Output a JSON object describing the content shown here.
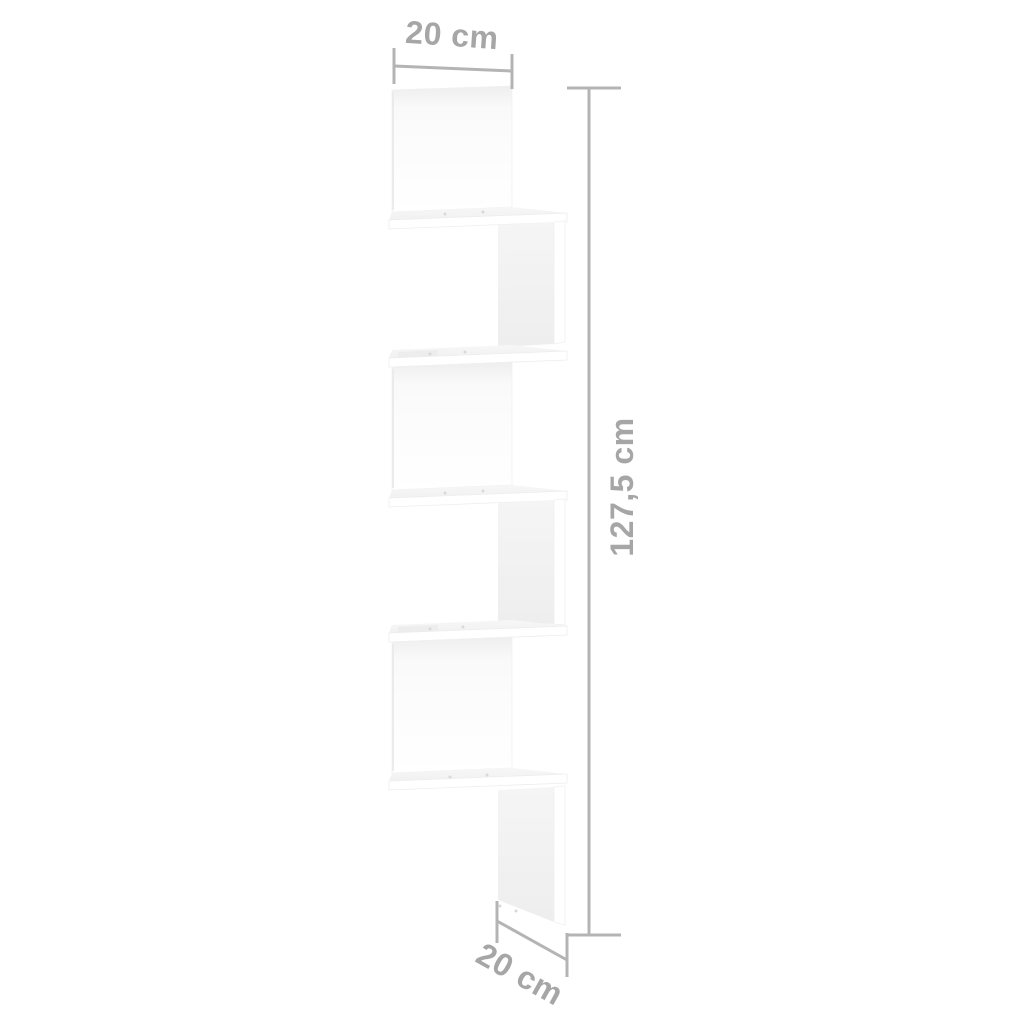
{
  "diagram": {
    "labels": {
      "width_top": "20 cm",
      "height_side": "127,5 cm",
      "depth_bottom": "20 cm"
    },
    "colors": {
      "background": "#ffffff",
      "dimension_line": "#b4b4b4",
      "dimension_text": "#a6a6a6",
      "panel_front": "#ffffff",
      "panel_side_shade": "#f1f1f1",
      "shelf_top_shade": "#f5f5f5",
      "edge_shade": "#ededed",
      "screw_dot": "#d9d9d9"
    }
  }
}
